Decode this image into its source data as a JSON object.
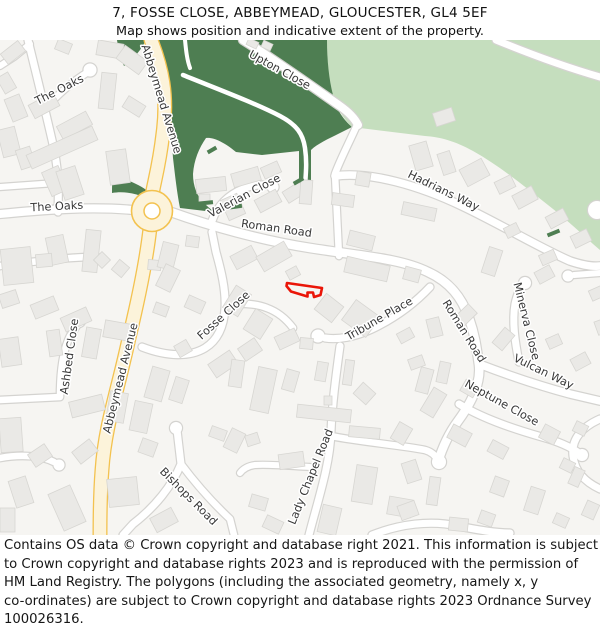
{
  "header": {
    "title": "7, FOSSE CLOSE, ABBEYMEAD, GLOUCESTER, GL4 5EF",
    "subtitle": "Map shows position and indicative extent of the property."
  },
  "footer": {
    "lines": [
      "Contains OS data © Crown copyright and database right 2021. This information is subject",
      "to Crown copyright and database rights 2023 and is reproduced with the permission of",
      "HM Land Registry. The polygons (including the associated geometry, namely x, y",
      "co-ordinates) are subject to Crown copyright and database rights 2023 Ordnance Survey",
      "100026316."
    ]
  },
  "map": {
    "colors": {
      "land": "#f6f5f2",
      "building": "#eae9e6",
      "building_stroke": "#d7d6d2",
      "road_casing": "#d4d3d0",
      "road_fill": "#ffffff",
      "avenue_fill": "#fcf3da",
      "avenue_casing": "#f3c24f",
      "green_dark": "#4e7e52",
      "green_light": "#c5debe",
      "label": "#383838",
      "property": "#ea1508"
    },
    "greens_light": [
      "M327,40 L600,40 L600,250 C588,240 570,222 548,205 C525,187 500,166 473,151 C455,141 440,137 425,136 L352,127 C344,119 336,108 332,94 C328,78 327,58 327,40 Z"
    ],
    "greens_dark": [
      "M158,40 L327,40 C327,60 329,80 333,95 C336,110 344,120 352,127 L340,133 C328,139 317,144 311,150 L311,187 L299,187 L299,151 L262,155 L236,152 C224,142 213,137 206,138 C199,148 194,160 193,174 C193,186 197,197 205,204 C209,208 212,210 214,212 L180,208 C177,193 175,175 173,158 C171,130 169,100 165,78 L158,40 Z",
      "M117,40 L146,40 C140,52 132,60 124,66 C120,57 118,48 117,40 Z",
      "M113,176 C126,179 139,184 149,192 L146,198 C135,193 123,191 112,193 C112,187 112,181 113,176 Z"
    ],
    "park_paths": [
      {
        "d": "M183,75 C215,88 255,103 280,116 C297,125 303,134 305,148 C307,162 306,172 305,186",
        "w": 4.5
      },
      {
        "d": "M185,40 C186,50 187,60 190,68",
        "w": 4
      }
    ],
    "roads": [
      {
        "d": "M28,40 C34,65 44,105 52,140 C58,165 59,185 58,212",
        "w": 7
      },
      {
        "d": "M46,108 C58,94 72,82 88,72",
        "w": 6.5
      },
      {
        "d": "M0,66 L14,57 L30,44",
        "w": 6
      },
      {
        "d": "M0,187 L56,183",
        "w": 6
      },
      {
        "d": "M0,214 C40,210 90,206 133,210",
        "w": 8
      },
      {
        "d": "M171,212 C210,226 260,240 310,248 C360,256 400,258 428,272 C450,282 462,298 469,318 C476,338 477,352 479,365 C481,382 472,402 458,421 C447,436 441,452 438,462",
        "w": 8.5
      },
      {
        "d": "M243,40 C272,58 310,85 340,106 C350,113 355,119 358,125",
        "w": 8
      },
      {
        "d": "M357,125 C349,143 340,160 335,174 L339,256",
        "w": 6.5
      },
      {
        "d": "M335,176 C370,171 420,186 462,206 C500,224 540,248 570,261 C582,265 592,267 600,266",
        "w": 7.5
      },
      {
        "d": "M212,221 C217,206 228,195 243,189 C255,184 266,184 272,187",
        "w": 7
      },
      {
        "d": "M142,347 C168,357 190,357 205,348 C218,340 224,326 225,308 C226,290 221,270 216,252 L212,232",
        "w": 7
      },
      {
        "d": "M225,305 C238,303 255,303 267,308 C278,312 287,320 293,328",
        "w": 6.5
      },
      {
        "d": "M430,287 C415,303 395,318 372,329 C355,337 338,340 325,338",
        "w": 7
      },
      {
        "d": "M519,362 C515,342 512,322 515,304 C517,295 520,288 524,284",
        "w": 7
      },
      {
        "d": "M479,364 C505,374 540,386 570,394 L600,401",
        "w": 7.5
      },
      {
        "d": "M459,404 C480,417 510,428 542,437 C560,442 572,448 579,453",
        "w": 7
      },
      {
        "d": "M340,346 C336,375 332,405 331,432 C330,465 318,500 309,535",
        "w": 7
      },
      {
        "d": "M331,436 C360,442 400,445 425,450 C432,452 436,456 438,461",
        "w": 6.5
      },
      {
        "d": "M310,467 C290,466 270,464 255,465 C248,466 243,469 240,473",
        "w": 6
      },
      {
        "d": "M177,430 L181,464 C172,486 155,507 133,524 L123,535",
        "w": 7
      },
      {
        "d": "M181,464 C196,484 214,504 230,519 L234,535",
        "w": 6.5
      },
      {
        "d": "M0,400 L60,397 C60,375 62,352 70,336 L78,324",
        "w": 6.5
      },
      {
        "d": "M0,266 C30,262 60,258 88,257",
        "w": 6.5
      },
      {
        "d": "M0,458 C22,454 42,456 54,462",
        "w": 6.5
      },
      {
        "d": "M600,273 L574,275",
        "w": 6
      },
      {
        "d": "M600,419 C582,427 571,439 573,456 C575,472 585,482 600,489",
        "w": 7
      },
      {
        "d": "M372,535 C400,524 430,520 458,526 C478,530 495,533 510,533",
        "w": 7
      },
      {
        "d": "M496,40 C530,54 565,67 600,77",
        "w": 7
      }
    ],
    "bulbs": [
      [
        90,
        70,
        6.5
      ],
      [
        273,
        187,
        5.5
      ],
      [
        318,
        336,
        6.5
      ],
      [
        525,
        283,
        6
      ],
      [
        582,
        455,
        6
      ],
      [
        439,
        462,
        7
      ],
      [
        79,
        321,
        6
      ],
      [
        94,
        258,
        6
      ],
      [
        59,
        465,
        5.5
      ],
      [
        568,
        276,
        5.5
      ],
      [
        176,
        428,
        6
      ],
      [
        597,
        210,
        9
      ]
    ],
    "avenue": {
      "d": "M151,40 C162,68 168,95 163,133 C159,168 153,186 152,196 M150,228 C147,255 141,288 129,338 C118,390 105,425 102,470 C100,495 100,515 100,535"
    },
    "roundabout": {
      "cx": 152,
      "cy": 211,
      "r_outer": 20.5,
      "r_inner": 8
    },
    "buildings": [
      [
        2,
        46,
        22,
        13,
        -38
      ],
      [
        0,
        74,
        13,
        18,
        -30
      ],
      [
        56,
        41,
        15,
        11,
        22
      ],
      [
        97,
        42,
        26,
        15,
        10
      ],
      [
        118,
        52,
        28,
        16,
        36
      ],
      [
        100,
        73,
        15,
        36,
        6
      ],
      [
        124,
        100,
        20,
        13,
        32
      ],
      [
        30,
        98,
        28,
        15,
        -28
      ],
      [
        58,
        118,
        33,
        15,
        -28
      ],
      [
        8,
        96,
        16,
        24,
        -22
      ],
      [
        0,
        128,
        18,
        28,
        -14
      ],
      [
        18,
        148,
        15,
        20,
        -18
      ],
      [
        26,
        140,
        72,
        15,
        -24
      ],
      [
        46,
        168,
        18,
        26,
        -24
      ],
      [
        60,
        168,
        20,
        30,
        -18
      ],
      [
        108,
        150,
        20,
        34,
        -8
      ],
      [
        2,
        248,
        30,
        36,
        -6
      ],
      [
        48,
        236,
        18,
        28,
        -12
      ],
      [
        84,
        230,
        15,
        42,
        6
      ],
      [
        0,
        292,
        18,
        14,
        -18
      ],
      [
        32,
        300,
        25,
        15,
        -22
      ],
      [
        62,
        312,
        28,
        15,
        -24
      ],
      [
        96,
        254,
        12,
        12,
        45
      ],
      [
        114,
        262,
        13,
        13,
        40
      ],
      [
        36,
        254,
        16,
        13,
        -5
      ],
      [
        84,
        328,
        15,
        30,
        10
      ],
      [
        48,
        330,
        13,
        26,
        -8
      ],
      [
        0,
        338,
        20,
        28,
        -8
      ],
      [
        70,
        398,
        34,
        16,
        -14
      ],
      [
        0,
        418,
        22,
        34,
        -4
      ],
      [
        30,
        448,
        20,
        15,
        -34
      ],
      [
        74,
        444,
        22,
        15,
        -38
      ],
      [
        12,
        478,
        18,
        28,
        -18
      ],
      [
        55,
        488,
        24,
        40,
        -24
      ],
      [
        108,
        478,
        30,
        28,
        -6
      ],
      [
        152,
        512,
        24,
        16,
        -28
      ],
      [
        0,
        508,
        15,
        24,
        0
      ],
      [
        140,
        440,
        16,
        15,
        20
      ],
      [
        148,
        260,
        13,
        10,
        5
      ],
      [
        160,
        243,
        16,
        26,
        14
      ],
      [
        186,
        236,
        13,
        11,
        8
      ],
      [
        160,
        266,
        16,
        24,
        26
      ],
      [
        186,
        298,
        18,
        13,
        24
      ],
      [
        154,
        304,
        14,
        11,
        20
      ],
      [
        104,
        322,
        26,
        17,
        10
      ],
      [
        148,
        368,
        18,
        32,
        16
      ],
      [
        132,
        402,
        18,
        30,
        12
      ],
      [
        108,
        392,
        18,
        30,
        10
      ],
      [
        210,
        356,
        26,
        16,
        -34
      ],
      [
        240,
        342,
        20,
        15,
        -34
      ],
      [
        176,
        342,
        14,
        13,
        -30
      ],
      [
        172,
        378,
        14,
        24,
        18
      ],
      [
        232,
        250,
        24,
        15,
        -28
      ],
      [
        258,
        248,
        32,
        17,
        -30
      ],
      [
        287,
        268,
        12,
        10,
        -28
      ],
      [
        228,
        288,
        18,
        26,
        32
      ],
      [
        248,
        312,
        20,
        24,
        32
      ],
      [
        276,
        332,
        22,
        14,
        -25
      ],
      [
        196,
        178,
        30,
        14,
        -6
      ],
      [
        232,
        170,
        28,
        14,
        -16
      ],
      [
        262,
        164,
        18,
        12,
        -24
      ],
      [
        199,
        194,
        11,
        9,
        0
      ],
      [
        224,
        196,
        18,
        22,
        -24
      ],
      [
        256,
        194,
        24,
        14,
        -28
      ],
      [
        284,
        186,
        20,
        13,
        -32
      ],
      [
        300,
        180,
        12,
        24,
        4
      ],
      [
        332,
        194,
        22,
        12,
        8
      ],
      [
        356,
        172,
        14,
        14,
        10
      ],
      [
        402,
        205,
        34,
        13,
        12
      ],
      [
        348,
        233,
        26,
        15,
        14
      ],
      [
        412,
        143,
        18,
        26,
        -16
      ],
      [
        440,
        152,
        13,
        22,
        -18
      ],
      [
        462,
        163,
        25,
        19,
        -28
      ],
      [
        496,
        178,
        18,
        13,
        -26
      ],
      [
        434,
        110,
        20,
        14,
        -18
      ],
      [
        514,
        190,
        22,
        15,
        -28
      ],
      [
        547,
        212,
        20,
        13,
        -28
      ],
      [
        572,
        232,
        18,
        13,
        -26
      ],
      [
        540,
        252,
        16,
        11,
        -24
      ],
      [
        505,
        225,
        14,
        11,
        -26
      ],
      [
        345,
        261,
        44,
        16,
        13
      ],
      [
        404,
        268,
        16,
        13,
        15
      ],
      [
        318,
        298,
        22,
        20,
        38
      ],
      [
        346,
        306,
        30,
        25,
        36
      ],
      [
        398,
        330,
        15,
        11,
        -28
      ],
      [
        300,
        338,
        13,
        11,
        5
      ],
      [
        428,
        318,
        13,
        19,
        -14
      ],
      [
        458,
        305,
        13,
        23,
        46
      ],
      [
        409,
        357,
        15,
        11,
        -20
      ],
      [
        230,
        360,
        13,
        27,
        8
      ],
      [
        254,
        368,
        19,
        44,
        12
      ],
      [
        284,
        370,
        13,
        21,
        16
      ],
      [
        316,
        362,
        11,
        19,
        10
      ],
      [
        344,
        360,
        9,
        25,
        8
      ],
      [
        356,
        386,
        17,
        15,
        42
      ],
      [
        418,
        368,
        13,
        25,
        15
      ],
      [
        438,
        362,
        11,
        21,
        12
      ],
      [
        462,
        382,
        15,
        13,
        30
      ],
      [
        297,
        407,
        54,
        13,
        6
      ],
      [
        324,
        396,
        8,
        9,
        0
      ],
      [
        227,
        430,
        15,
        21,
        26
      ],
      [
        279,
        453,
        25,
        15,
        -8
      ],
      [
        349,
        427,
        31,
        11,
        5
      ],
      [
        394,
        424,
        15,
        19,
        30
      ],
      [
        354,
        466,
        21,
        37,
        9
      ],
      [
        320,
        506,
        19,
        28,
        13
      ],
      [
        388,
        498,
        24,
        18,
        10
      ],
      [
        250,
        496,
        17,
        13,
        16
      ],
      [
        210,
        428,
        16,
        11,
        20
      ],
      [
        246,
        434,
        13,
        11,
        -18
      ],
      [
        264,
        518,
        18,
        13,
        25
      ],
      [
        426,
        389,
        15,
        27,
        31
      ],
      [
        449,
        428,
        21,
        15,
        28
      ],
      [
        489,
        443,
        18,
        13,
        28
      ],
      [
        541,
        427,
        17,
        15,
        28
      ],
      [
        574,
        423,
        13,
        11,
        26
      ],
      [
        492,
        478,
        15,
        17,
        20
      ],
      [
        527,
        488,
        15,
        25,
        18
      ],
      [
        554,
        515,
        14,
        11,
        24
      ],
      [
        479,
        512,
        15,
        13,
        20
      ],
      [
        428,
        477,
        11,
        28,
        8
      ],
      [
        404,
        461,
        15,
        21,
        -18
      ],
      [
        399,
        503,
        18,
        15,
        -20
      ],
      [
        449,
        518,
        19,
        13,
        6
      ],
      [
        571,
        468,
        11,
        18,
        24
      ],
      [
        584,
        502,
        13,
        16,
        24
      ],
      [
        561,
        460,
        13,
        11,
        26
      ],
      [
        485,
        248,
        14,
        27,
        18
      ],
      [
        536,
        268,
        17,
        13,
        -28
      ],
      [
        547,
        336,
        14,
        11,
        -24
      ],
      [
        572,
        355,
        17,
        13,
        -28
      ],
      [
        590,
        288,
        13,
        11,
        -24
      ],
      [
        497,
        329,
        13,
        20,
        40
      ],
      [
        596,
        320,
        10,
        14,
        -20
      ],
      [
        247,
        40,
        11,
        7,
        25
      ],
      [
        262,
        42,
        10,
        7,
        25
      ]
    ],
    "hedges": [
      [
        196,
        201,
        17,
        4,
        -6
      ],
      [
        224,
        205,
        18,
        4,
        -8
      ],
      [
        293,
        179,
        11,
        4,
        -30
      ],
      [
        180,
        194,
        10,
        4,
        -22
      ],
      [
        547,
        231,
        13,
        4,
        -22
      ],
      [
        207,
        148,
        10,
        4,
        -30
      ]
    ],
    "property_outline": {
      "points": "287,283 322,288 320.5,295 314,297 313,292.5 307.5,292.5 307.5,296.5 291,291.5 286.5,286"
    },
    "labels": [
      {
        "text": "The Oaks",
        "x": 61,
        "y": 93,
        "rot": -27
      },
      {
        "text": "Abbeymead Avenue",
        "x": 158,
        "y": 100,
        "rot": 73
      },
      {
        "text": "Upton Close",
        "x": 278,
        "y": 73,
        "rot": 29
      },
      {
        "text": "The Oaks",
        "x": 57,
        "y": 210,
        "rot": -3
      },
      {
        "text": "Valerian Close",
        "x": 246,
        "y": 199,
        "rot": -28
      },
      {
        "text": "Roman Road",
        "x": 276,
        "y": 232,
        "rot": 8
      },
      {
        "text": "Hadrians Way",
        "x": 442,
        "y": 194,
        "rot": 26
      },
      {
        "text": "Fosse Close",
        "x": 226,
        "y": 318,
        "rot": -42
      },
      {
        "text": "Ashbed Close",
        "x": 73,
        "y": 357,
        "rot": -82
      },
      {
        "text": "Abbeymead Avenue",
        "x": 124,
        "y": 379,
        "rot": -76
      },
      {
        "text": "Tribune Place",
        "x": 381,
        "y": 322,
        "rot": -30
      },
      {
        "text": "Roman Road",
        "x": 461,
        "y": 333,
        "rot": 58
      },
      {
        "text": "Minerva Close",
        "x": 523,
        "y": 322,
        "rot": 76
      },
      {
        "text": "Vulcan Way",
        "x": 542,
        "y": 375,
        "rot": 26
      },
      {
        "text": "Neptune Close",
        "x": 500,
        "y": 406,
        "rot": 29
      },
      {
        "text": "Bishops Road",
        "x": 186,
        "y": 499,
        "rot": 45
      },
      {
        "text": "Lady Chapel Road",
        "x": 314,
        "y": 478,
        "rot": -68
      }
    ]
  }
}
